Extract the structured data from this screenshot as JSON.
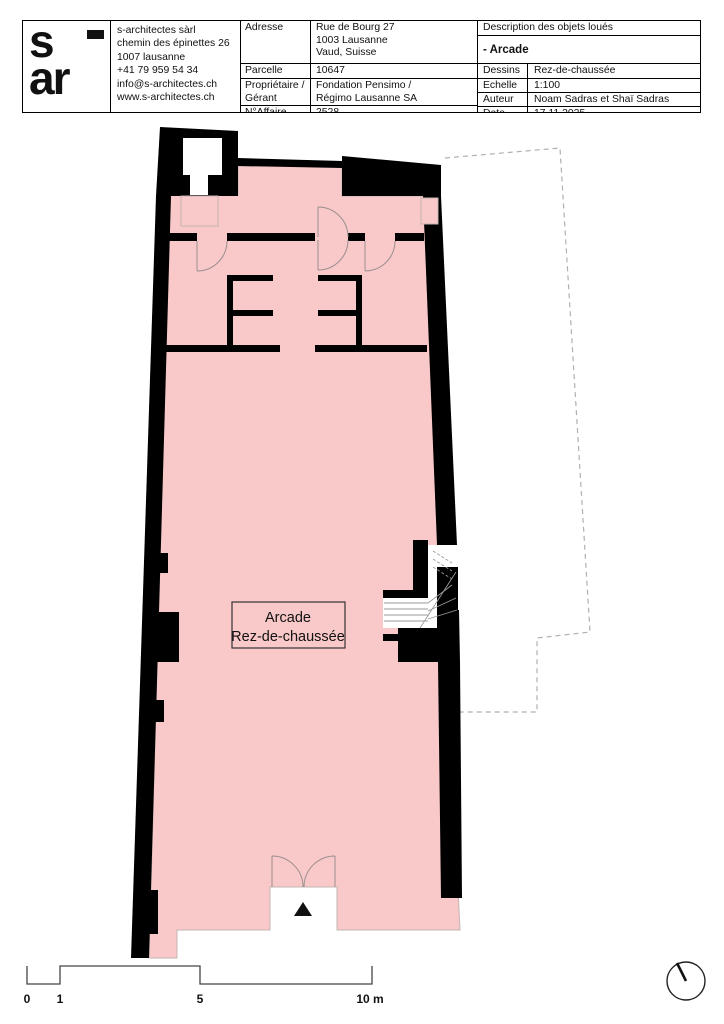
{
  "colors": {
    "floor_pink": "#f9c8c8",
    "wall_black": "#000000",
    "floor_outline_gray": "#c5b3b3",
    "dashed_parcel_gray": "#b0b0b0"
  },
  "title_block": {
    "logo": {
      "letter_s": "s",
      "letters_ar": "ar"
    },
    "company": {
      "lines": [
        "s-architectes sàrl",
        "chemin des épinettes 26",
        "1007 lausanne",
        "+41 79 959 54 34",
        "info@s-architectes.ch",
        "www.s-architectes.ch"
      ]
    },
    "fields": {
      "adresse_label": "Adresse",
      "adresse_line1": "Rue de Bourg 27",
      "adresse_line2": "1003 Lausanne",
      "adresse_line3": "Vaud, Suisse",
      "parcelle_label": "Parcelle",
      "parcelle_value": "10647",
      "proprietaire_label_line1": "Propriétaire /",
      "proprietaire_label_line2": "Gérant",
      "proprietaire_value_line1": "Fondation Pensimo /",
      "proprietaire_value_line2": "Régimo Lausanne SA",
      "affaire_label": "N°Affaire",
      "affaire_value": "2528"
    },
    "right": {
      "description_header": "Description des objets loués",
      "object_value": "- Arcade",
      "dessins_label": "Dessins",
      "dessins_value": "Rez-de-chaussée",
      "echelle_label": "Echelle",
      "echelle_value": "1:100",
      "auteur_label": "Auteur",
      "auteur_value": "Noam Sadras et Shaï Sadras",
      "date_label": "Date",
      "date_value": "17.11.2025"
    }
  },
  "plan": {
    "room_label_line1": "Arcade",
    "room_label_line2": "Rez-de-chaussée"
  },
  "scale_bar": {
    "label_0": "0",
    "label_1": "1",
    "label_5": "5",
    "label_10": "10 m"
  }
}
